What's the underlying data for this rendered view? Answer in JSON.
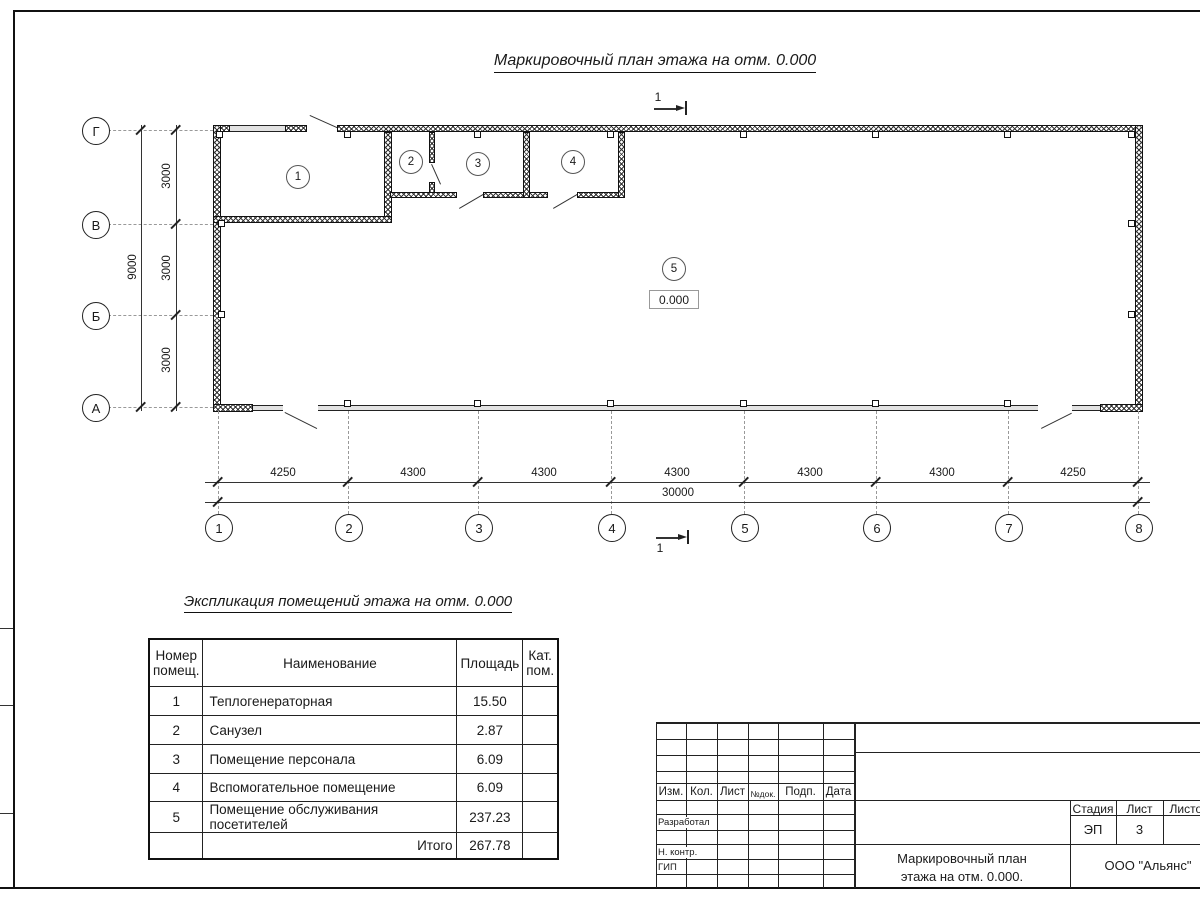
{
  "plan_title": "Маркировочный план этажа на отм. 0.000",
  "section_mark_label": "1",
  "elevation_value": "0.000",
  "grid": {
    "cols": [
      "1",
      "2",
      "3",
      "4",
      "5",
      "6",
      "7",
      "8"
    ],
    "rows": [
      "Г",
      "В",
      "Б",
      "А"
    ],
    "col_dims": [
      "4250",
      "4300",
      "4300",
      "4300",
      "4300",
      "4300",
      "4250"
    ],
    "col_total": "30000",
    "row_dims": [
      "3000",
      "3000",
      "3000"
    ],
    "row_total": "9000"
  },
  "room_marks": [
    "1",
    "2",
    "3",
    "4",
    "5"
  ],
  "explication": {
    "title": "Экспликация помещений этажа на отм. 0.000",
    "col_headers": [
      "Номер помещ.",
      "Наименование",
      "Площадь",
      "Кат. пом."
    ],
    "rows": [
      {
        "num": "1",
        "name": "Теплогенераторная",
        "area": "15.50",
        "cat": ""
      },
      {
        "num": "2",
        "name": "Санузел",
        "area": "2.87",
        "cat": ""
      },
      {
        "num": "3",
        "name": "Помещение персонала",
        "area": "6.09",
        "cat": ""
      },
      {
        "num": "4",
        "name": "Вспомогательное помещение",
        "area": "6.09",
        "cat": ""
      },
      {
        "num": "5",
        "name": "Помещение обслуживания посетителей",
        "area": "237.23",
        "cat": ""
      }
    ],
    "total_label": "Итого",
    "total_area": "267.78"
  },
  "title_block": {
    "change_header": [
      "Изм.",
      "Кол.",
      "Лист",
      "№док.",
      "Подп.",
      "Дата"
    ],
    "role_labels": [
      "Разработал",
      "Н. контр.",
      "ГИП"
    ],
    "stage_header": "Стадия",
    "sheet_header": "Лист",
    "sheets_header": "Листов",
    "stage": "ЭП",
    "sheet": "3",
    "doc_title": "Маркировочный план этажа на отм. 0.000.",
    "company": "ООО \"Альянс\""
  }
}
